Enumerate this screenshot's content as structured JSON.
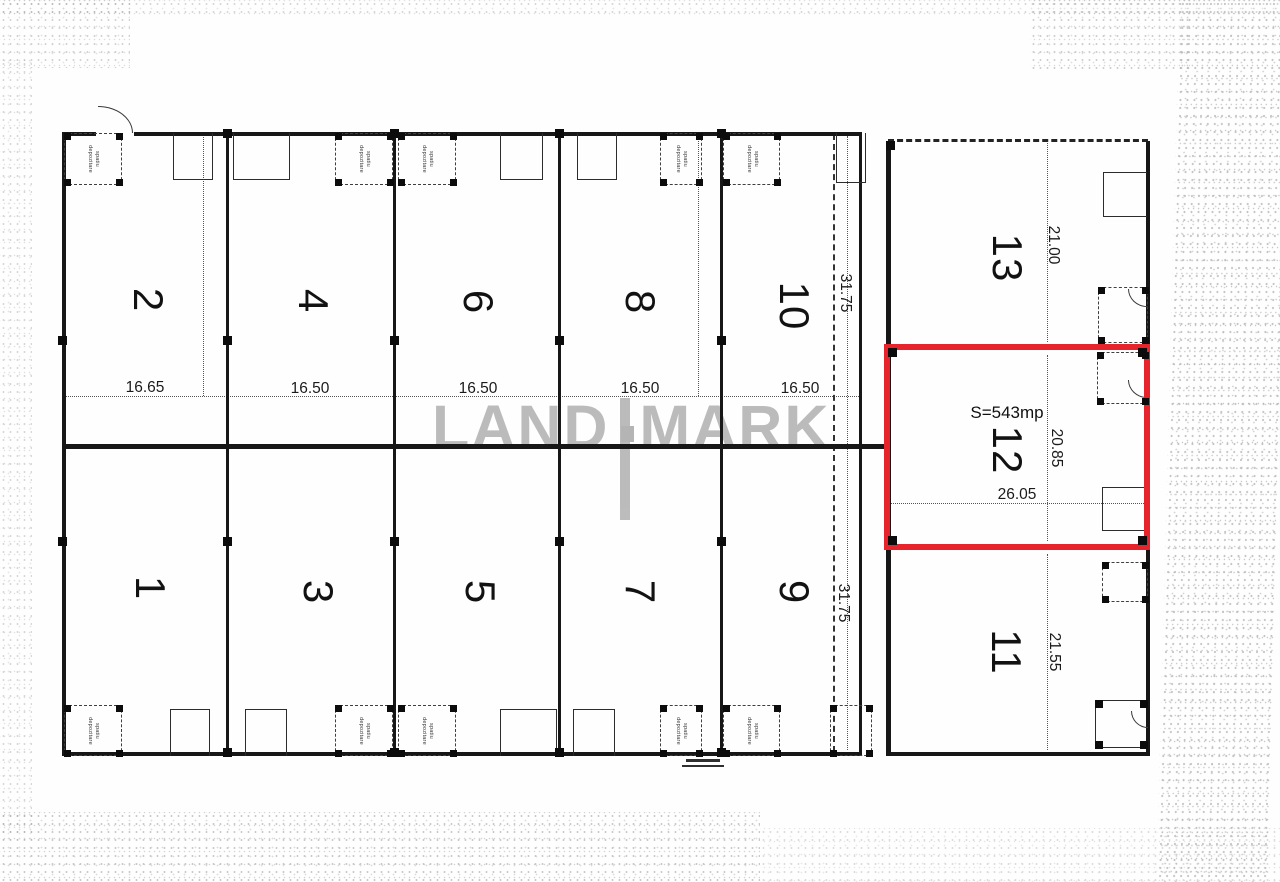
{
  "watermark": {
    "word1": "LAND",
    "word2": "MARK",
    "color": "#b6b6b6"
  },
  "highlight_unit": {
    "number": "12",
    "area_label": "S=543mp",
    "outline_color": "#e7242b"
  },
  "units": {
    "u1": "1",
    "u2": "2",
    "u3": "3",
    "u4": "4",
    "u5": "5",
    "u6": "6",
    "u7": "7",
    "u8": "8",
    "u9": "9",
    "u10": "10",
    "u11": "11",
    "u12": "12",
    "u13": "13"
  },
  "dimensions": {
    "bay_widths": [
      "16.65",
      "16.50",
      "16.50",
      "16.50",
      "16.50"
    ],
    "corridor_top": "31.75",
    "corridor_bottom": "31.75",
    "unit13_depth": "21.00",
    "unit12_depth": "20.85",
    "unit12_width": "26.05",
    "unit11_depth": "21.55"
  },
  "storage_box_label": {
    "line1": "spatiu",
    "line2": "depozitare"
  }
}
